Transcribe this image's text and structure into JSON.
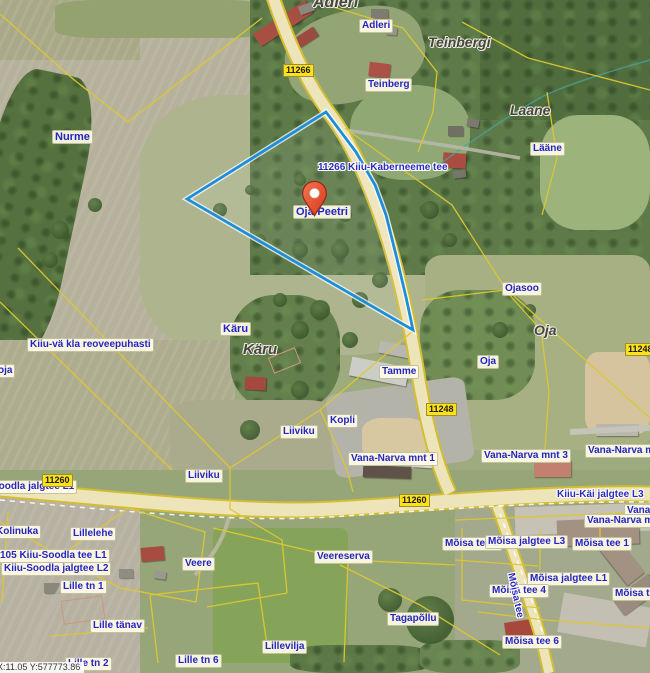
{
  "map": {
    "coordinate_readout": "X:11.05 Y:577773.86",
    "marker": {
      "label": "Oja-Peetri",
      "tip_x": 315,
      "tip_y": 217
    },
    "colors": {
      "selection_blue": "#1e8ed8",
      "cadastral_yellow": "#ddc72f",
      "label_text_blue": "#2525c0",
      "road_badge_yellow": "#ffe11a",
      "marker_red": "#e8502e",
      "road_fill": "#eee4ba"
    },
    "parcel_labels": [
      {
        "text": "Adleri",
        "x": 359,
        "y": 19
      },
      {
        "text": "Teinberg",
        "x": 365,
        "y": 78
      },
      {
        "text": "Nurme",
        "x": 52,
        "y": 130,
        "size": 11
      },
      {
        "text": "Lääne",
        "x": 530,
        "y": 142
      },
      {
        "text": "Oja-Peetri",
        "x": 293,
        "y": 205,
        "size": 11
      },
      {
        "text": "Ojasoo",
        "x": 502,
        "y": 282
      },
      {
        "text": "Käru",
        "x": 220,
        "y": 322,
        "size": 11
      },
      {
        "text": "Kiiu-vä kla reoveepuhasti",
        "x": 27,
        "y": 338
      },
      {
        "text": "oja",
        "x": -5,
        "y": 364
      },
      {
        "text": "Oja",
        "x": 477,
        "y": 355
      },
      {
        "text": "Tamme",
        "x": 379,
        "y": 365
      },
      {
        "text": "Kopli",
        "x": 327,
        "y": 414
      },
      {
        "text": "Liiviku",
        "x": 280,
        "y": 425
      },
      {
        "text": "Liiviku",
        "x": 185,
        "y": 469
      },
      {
        "text": "Vana-Narva mnt 1",
        "x": 348,
        "y": 452
      },
      {
        "text": "Vana-Narva mnt 3",
        "x": 481,
        "y": 449
      },
      {
        "text": "Vana-Narva mnt",
        "x": 585,
        "y": 444
      },
      {
        "text": "Soodla jalgtee L1",
        "x": -11,
        "y": 480
      },
      {
        "text": "Vana-",
        "x": 624,
        "y": 504
      },
      {
        "text": "Vana-Narva mnt",
        "x": 584,
        "y": 514
      },
      {
        "text": "Kolinuka",
        "x": -7,
        "y": 525
      },
      {
        "text": "Lillelehe",
        "x": 70,
        "y": 527
      },
      {
        "text": "Mõisa tee 2",
        "x": 442,
        "y": 537
      },
      {
        "text": "Mõisa jalgtee L3",
        "x": 485,
        "y": 535
      },
      {
        "text": "Mõisa tee 1",
        "x": 572,
        "y": 537
      },
      {
        "text": "105 Kiiu-Soodla tee L1",
        "x": -3,
        "y": 549
      },
      {
        "text": "Kiiu-Soodla jalgtee L2",
        "x": 1,
        "y": 562
      },
      {
        "text": "Veereserva",
        "x": 314,
        "y": 550
      },
      {
        "text": "Veere",
        "x": 182,
        "y": 557
      },
      {
        "text": "Mõisa jalgtee L1",
        "x": 527,
        "y": 572
      },
      {
        "text": "Lille tn 1",
        "x": 60,
        "y": 580
      },
      {
        "text": "Mõisa tee 4",
        "x": 489,
        "y": 584
      },
      {
        "text": "Mõisa tee",
        "x": 612,
        "y": 587
      },
      {
        "text": "Tagapõllu",
        "x": 387,
        "y": 612
      },
      {
        "text": "Lille tänav",
        "x": 90,
        "y": 619
      },
      {
        "text": "Mõisa tee 6",
        "x": 502,
        "y": 635
      },
      {
        "text": "Lillevilja",
        "x": 262,
        "y": 640
      },
      {
        "text": "Lille tn 6",
        "x": 175,
        "y": 654
      },
      {
        "text": "Lille tn 2",
        "x": 65,
        "y": 657
      }
    ],
    "area_names": [
      {
        "text": "Adleri",
        "x": 313,
        "y": -6,
        "size": 16
      },
      {
        "text": "Teinbergi",
        "x": 428,
        "y": 34,
        "size": 14
      },
      {
        "text": "Laane",
        "x": 510,
        "y": 102,
        "size": 14
      },
      {
        "text": "Käru",
        "x": 243,
        "y": 341,
        "size": 15
      },
      {
        "text": "Oja",
        "x": 534,
        "y": 322,
        "size": 14
      }
    ],
    "road_name_labels": [
      {
        "text": "11266 Kiiu-Kaberneeme tee",
        "x": 318,
        "y": 162,
        "rot": 0
      },
      {
        "text": "Kiiu-Käi jalgtee L3",
        "x": 557,
        "y": 489,
        "rot": 0
      },
      {
        "text": "Mõisa tee",
        "x": 516,
        "y": 572,
        "rot": 78
      }
    ],
    "road_badges": [
      {
        "text": "11266",
        "x": 283,
        "y": 64
      },
      {
        "text": "11248",
        "x": 426,
        "y": 403
      },
      {
        "text": "11248",
        "x": 625,
        "y": 343
      },
      {
        "text": "11260",
        "x": 42,
        "y": 474
      },
      {
        "text": "11260",
        "x": 399,
        "y": 494
      }
    ]
  }
}
